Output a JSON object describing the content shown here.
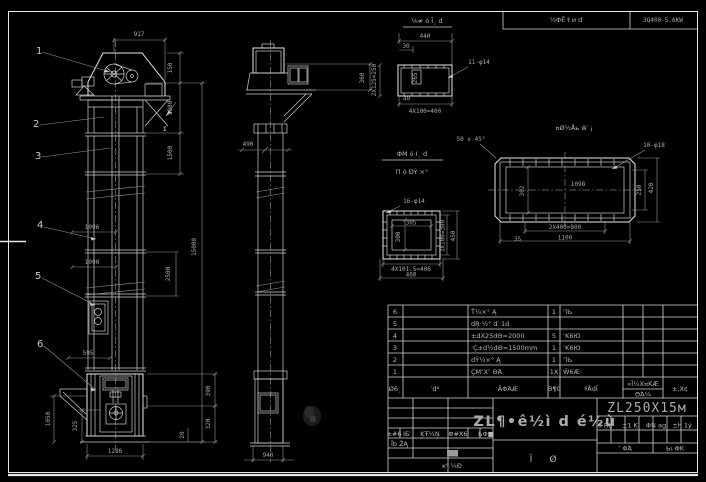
{
  "colors": {
    "background": "#000000",
    "line": "#e8e8e8",
    "dim_line": "#969696",
    "dim_text": "#a8a8a8",
    "text_bright": "#d8d8d8",
    "highlight_cell": "#9a9a9a"
  },
  "header_strip": {
    "motor_label": "½ΦÊ ŧ и d",
    "motor_spec": "3Q400-5.6KW"
  },
  "front_view": {
    "callouts": [
      "1",
      "2",
      "3",
      "4",
      "5",
      "6"
    ],
    "section_label": "I",
    "dims": {
      "width_head": "917",
      "h_150": "150",
      "h_1080": "1080",
      "h_1500": "1500",
      "h_total": "15000",
      "h_2500": "2500",
      "w_1096": "1096",
      "w_1090": "1090",
      "w_595": "595",
      "h_1050": "1050",
      "h_325": "325",
      "w_base": "1286",
      "h_390": "390",
      "h_320": "320",
      "h_20": "20"
    }
  },
  "side_view": {
    "dims": {
      "w_490": "490",
      "h_360": "360",
      "w_base": "940"
    }
  },
  "details": {
    "flange_top": {
      "title": "⅛≠ ó Ī¸ d",
      "holes": "11-φ14",
      "w_440": "440",
      "w_30": "30",
      "left": "2X125=250",
      "bottom": "4X100=400",
      "inner": "265",
      "corner": "40"
    },
    "flange_long": {
      "title": "¤Ø½Åь ŵ′ ¡",
      "chamfer": "50 x 45°",
      "holes": "10-φ18",
      "inner": "1098",
      "left": "302",
      "right_250": "250",
      "right_420": "420",
      "bottom_800": "2X400=800",
      "bottom_1100": "1100",
      "corner": "35"
    },
    "flange_square": {
      "title_1": "ΦΜ ó Ι¸ d",
      "title_2": "Π ó ĐÝ ×°",
      "holes": "16-φ14",
      "inner_w": "305",
      "inner_h": "300",
      "right_1": "3X100=300",
      "right_2": "450",
      "bottom_1": "4X101.5=406",
      "bottom_2": "460"
    }
  },
  "bom": {
    "header": {
      "sn": "Ø6¸",
      "code": "′d⁶",
      "name": "ÃΦΆÆ",
      "qty": "Θ¶0",
      "material": "ªÅdĪ",
      "weight_top": "«Ī¼Χ¤ΚÆ",
      "weight_bottom": "ΘΆ¼",
      "remark": "±,Χ¢"
    },
    "rows": [
      {
        "sn": "6",
        "name": "Ť¼×° Ą",
        "qty": "1",
        "material": "ʻΊЬ"
      },
      {
        "sn": "5",
        "name": "dŖ·½° d′ 1d",
        "qty": "",
        "material": ""
      },
      {
        "sn": "4",
        "name": "±dΧ25dΘ=2000",
        "qty": "5",
        "material": "ʼΚ6Ю"
      },
      {
        "sn": "3",
        "name": "·Ç±d½dΘ=1500mm",
        "qty": "1",
        "material": "ʼΚ6Ю"
      },
      {
        "sn": "2",
        "name": "dΫ¼×° Ą",
        "qty": "1",
        "material": "ʻΊЬ"
      },
      {
        "sn": "1",
        "name": "ÇΜ″Χ″ ΘΆ",
        "qty": "1Χ",
        "material": "Ŵ6Æ·"
      }
    ]
  },
  "title_block": {
    "drawing_title": "ZL¶•ê½ì d é½ù",
    "drawing_no": "ZL250X15м",
    "mark_1": "Ĭ",
    "mark_2": "Ø",
    "rev_header": [
      "±#6",
      "ⅠБ′",
      "ĶŦ¼Ņ",
      "Φ#Χ6",
      "ЬΦ■"
    ],
    "rev_row": "Ĭb ŽĄ",
    "rev_bottom": "ĸ⁰ ¼Ð",
    "info_header": [
      "Ⅰб ŖĻ",
      "±1 Ķ",
      "ΦΝ ag",
      "±h 1ý"
    ],
    "sheet_left": "″ ΦΆ",
    "sheet_right": "Ьι ΦΚ"
  }
}
